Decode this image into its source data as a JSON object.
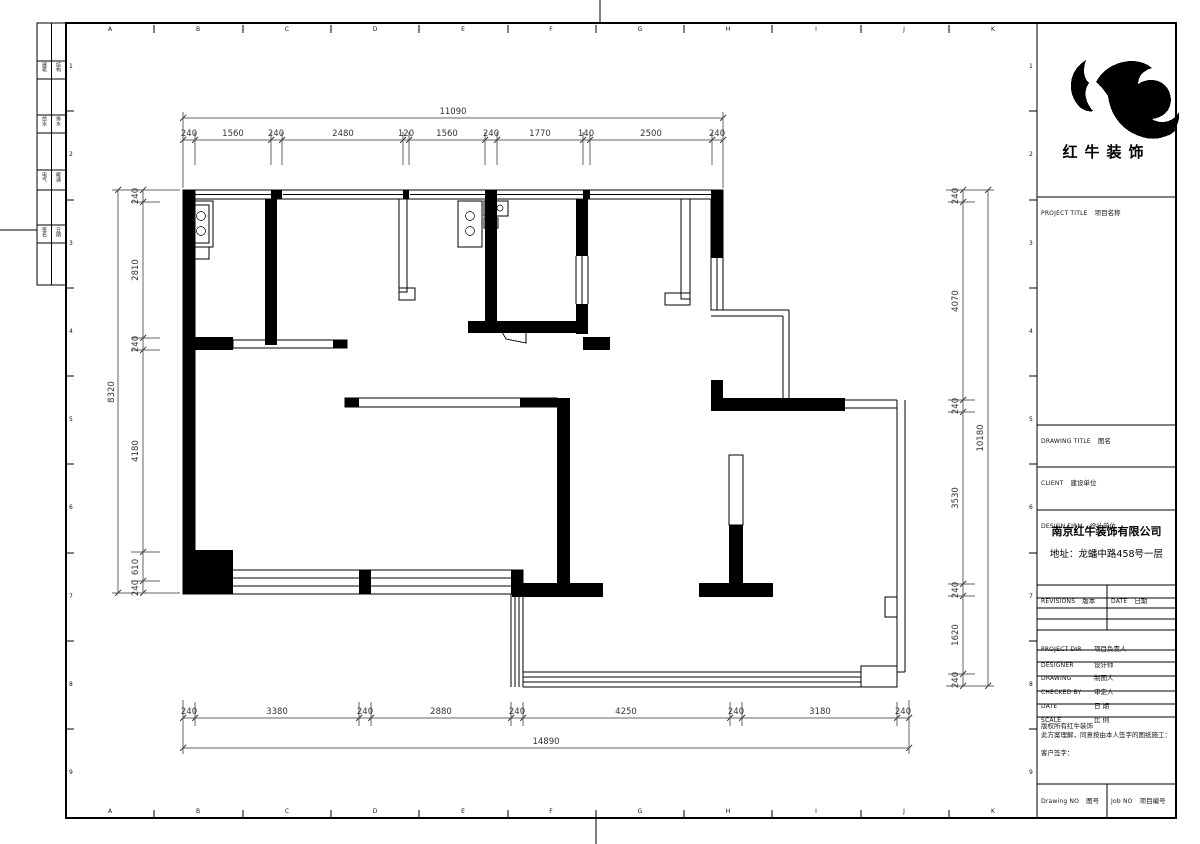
{
  "sheet": {
    "letters": [
      "A",
      "B",
      "C",
      "D",
      "E",
      "F",
      "G",
      "H",
      "I",
      "J",
      "K"
    ],
    "numbers": [
      "1",
      "2",
      "3",
      "4",
      "5",
      "6",
      "7",
      "8",
      "9"
    ]
  },
  "sign_column": {
    "rows": [
      {
        "a": "建筑",
        "b": "结构"
      },
      {
        "a": "给水",
        "b": "排水"
      },
      {
        "a": "电气",
        "b": "暖通"
      },
      {
        "a": "签名",
        "b": "日期"
      }
    ]
  },
  "title_block": {
    "logo_text": "红牛装饰",
    "logo_icon": "bull-swoosh",
    "project_title": {
      "en": "PROJECT TITLE",
      "zh": "项目名称"
    },
    "drawing_title": {
      "en": "DRAWING TITLE",
      "zh": "图名"
    },
    "client": {
      "en": "CLIENT",
      "zh": "建设单位"
    },
    "design_firm": {
      "en": "DESIGN FIRM",
      "zh": "设计单位"
    },
    "company_name": "南京红牛装饰有限公司",
    "company_address": "地址：龙蟠中路458号一层",
    "revisions": {
      "en": "REVISIONS",
      "zh": "版本"
    },
    "date_col": {
      "en": "DATE",
      "zh": "日期"
    },
    "project_dir": {
      "en": "PROJECT DIR",
      "zh": "项目负责人"
    },
    "designer": {
      "en": "DESIGNER",
      "zh": "设计师"
    },
    "drawing_by": {
      "en": "DRAWING",
      "zh": "制图人"
    },
    "checked_by": {
      "en": "CHECKED BY",
      "zh": "审定人"
    },
    "date_row": {
      "en": "DATE",
      "zh": "日 期"
    },
    "scale_row": {
      "en": "SCALE",
      "zh": "比 例"
    },
    "copyright_line1": "版权所有红牛装饰",
    "copyright_line2": "此方案理解，同意按由本人签字的图纸施工：",
    "client_sign": "客户签字：",
    "drawing_no": {
      "en": "Drawing NO",
      "zh": "图号"
    },
    "job_no": {
      "en": "Job NO",
      "zh": "项目编号"
    }
  },
  "dims": {
    "top": {
      "total": "11090",
      "segments": [
        "240",
        "1560",
        "240",
        "2480",
        "120",
        "1560",
        "240",
        "1770",
        "140",
        "2500",
        "240"
      ]
    },
    "bottom": {
      "total": "14890",
      "segments": [
        "240",
        "3380",
        "240",
        "2880",
        "240",
        "4250",
        "240",
        "3180",
        "240"
      ]
    },
    "left": {
      "total": "8320",
      "segments": [
        "240",
        "2810",
        "240",
        "4180",
        "610",
        "240"
      ]
    },
    "right": {
      "total": "10180",
      "segments": [
        "240",
        "4070",
        "240",
        "3530",
        "240",
        "1620",
        "240"
      ]
    }
  }
}
